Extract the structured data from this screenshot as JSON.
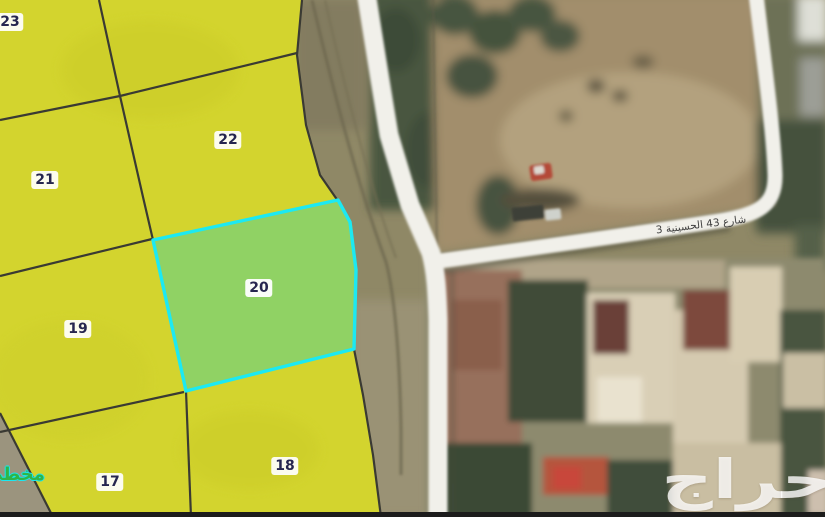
{
  "map_overlay": {
    "plan_label": "مخطط",
    "highlighted_parcel": "20",
    "parcels": [
      {
        "number": "23"
      },
      {
        "number": "21"
      },
      {
        "number": "22"
      },
      {
        "number": "20",
        "highlighted": true
      },
      {
        "number": "19"
      },
      {
        "number": "17"
      },
      {
        "number": "18"
      }
    ],
    "colors": {
      "parcel_fill": "#d3d42e",
      "parcel_line": "#3a3a33",
      "highlight_fill": "#90d264",
      "highlight_border": "#1ce9f2",
      "label_text": "#26264f",
      "label_bg": "#ffffff",
      "plan_label_green": "#2fb548"
    }
  },
  "satellite": {
    "street_label": "شارع 43 الحسينية 3",
    "road_color": "#f1f0ea"
  },
  "watermark": {
    "text": "حراج",
    "color": "rgba(255,255,255,0.8)"
  }
}
